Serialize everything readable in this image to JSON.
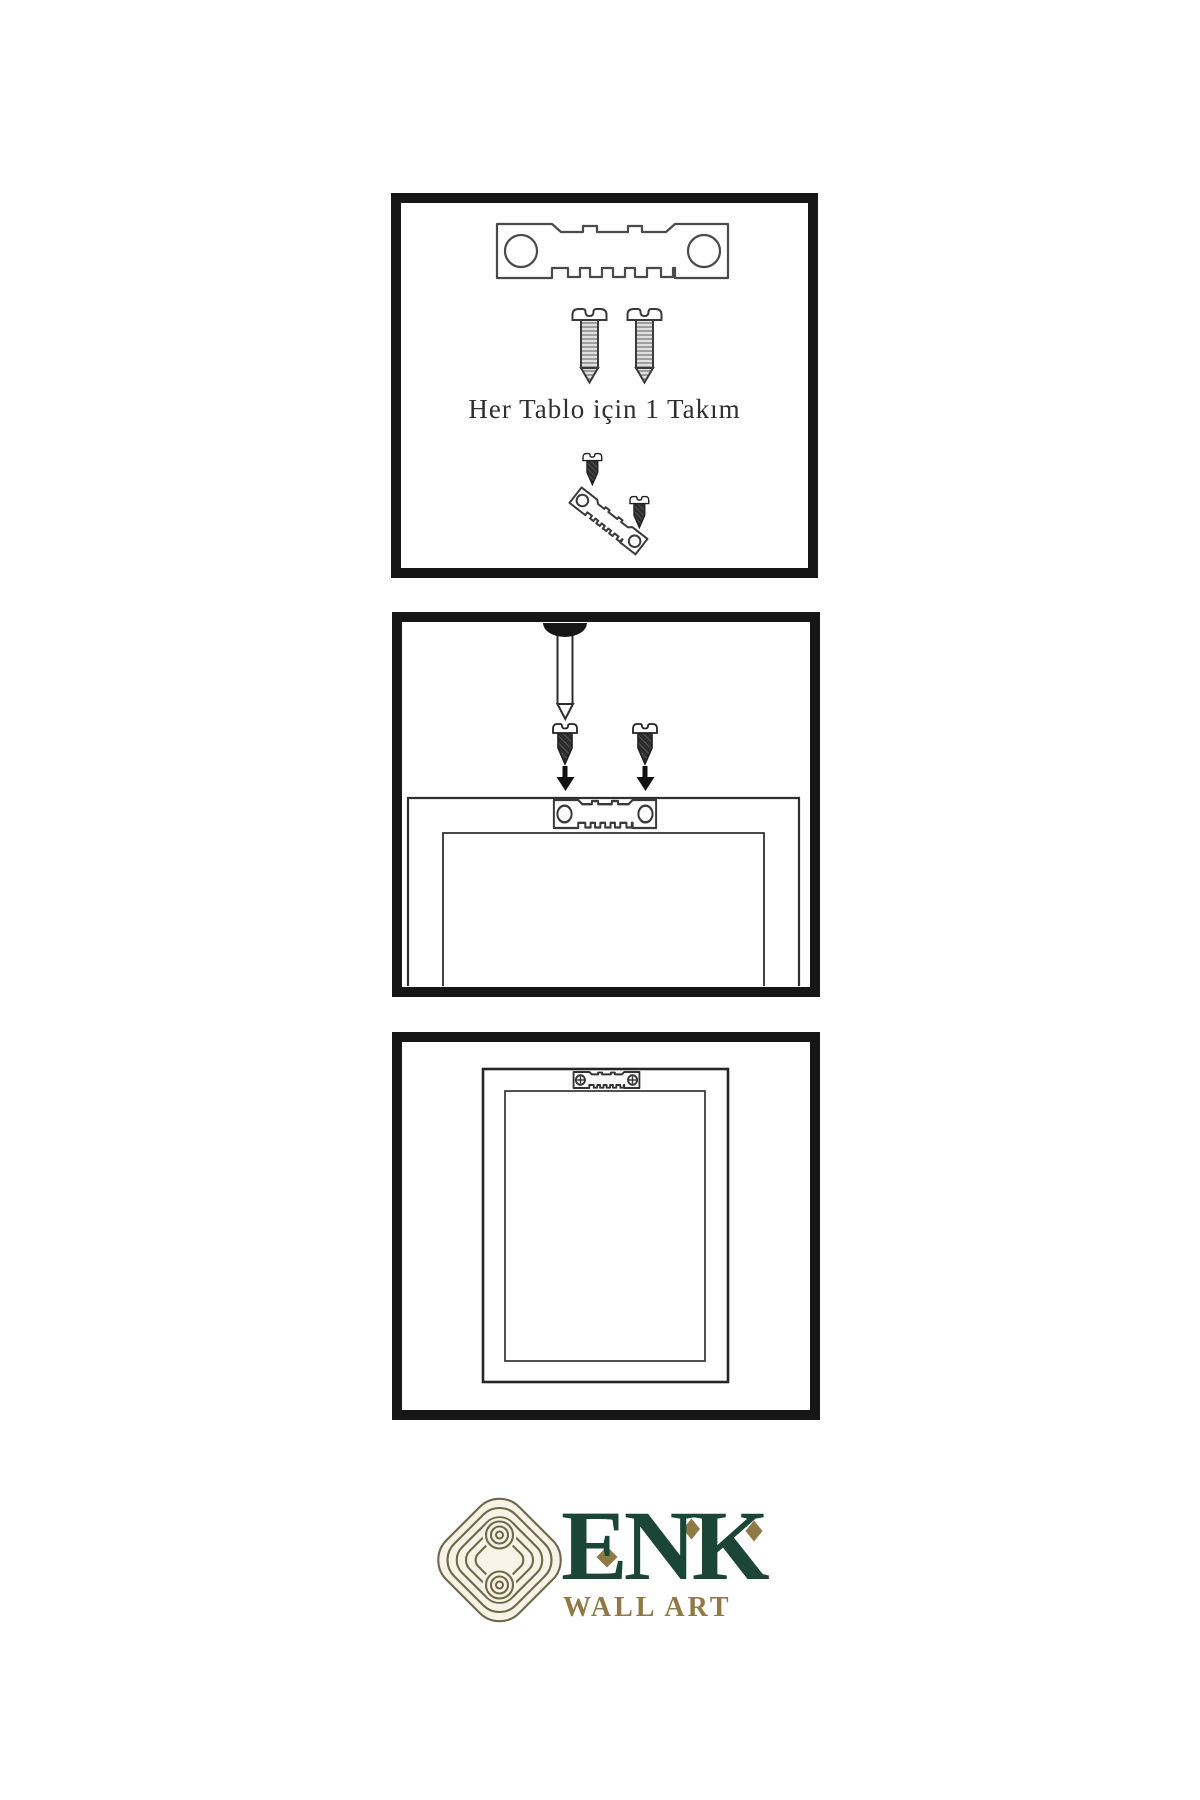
{
  "steps": {
    "step1": {
      "caption": "Her Tablo için 1 Takım",
      "contents": [
        "sawtooth-hanger",
        "two-screws",
        "hanger-with-screws-angled"
      ]
    },
    "step2": {
      "contents": [
        "wall-nail",
        "two-screws",
        "down-arrows",
        "frame-back-with-hanger"
      ]
    },
    "step3": {
      "contents": [
        "hanging-frame-back-with-mounted-hanger"
      ]
    }
  },
  "brand": {
    "name": "ENK",
    "subtitle": "WALL ART"
  },
  "colors": {
    "panel_border": "#161616",
    "line_art": "#3a3a3a",
    "brand_green": "#1b4537",
    "brand_gold": "#8f7a45",
    "knot_olive": "#6f6749",
    "knot_fill": "#f7f4e7",
    "page_background": "#ffffff"
  }
}
